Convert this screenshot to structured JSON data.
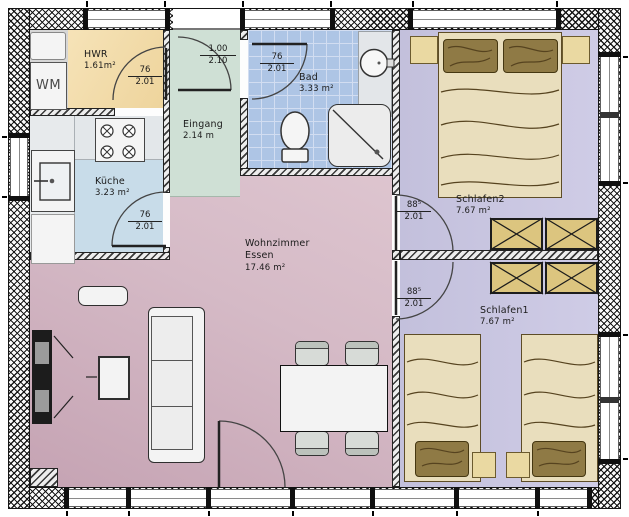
{
  "rooms": {
    "hwr": {
      "name": "HWR",
      "area": "1.61m²"
    },
    "eingang": {
      "name": "Eingang",
      "area": "2.14 m"
    },
    "bad": {
      "name": "Bad",
      "area": "3.33 m²"
    },
    "kueche": {
      "name": "Küche",
      "area": "3.23 m²"
    },
    "wohnzimmer": {
      "name1": "Wohnzimmer",
      "name2": "Essen",
      "area": "17.46 m²"
    },
    "schlafen2": {
      "name": "Schlafen2",
      "area": "7.67 m²"
    },
    "schlafen1": {
      "name": "Schlafen1",
      "area": "7.67 m²"
    }
  },
  "appliances": {
    "washing_machine": "WM"
  },
  "doors": {
    "hwr_door": {
      "width": "76",
      "height": "2.01"
    },
    "entry_door": {
      "width": "1.00",
      "height": "2.10"
    },
    "bad_door": {
      "width": "76",
      "height": "2.01"
    },
    "kueche_door": {
      "width": "76",
      "height": "2.01"
    },
    "schlafen2_door": {
      "width": "88⁵",
      "height": "2.01"
    },
    "schlafen1_door": {
      "width": "88⁵",
      "height": "2.01"
    }
  },
  "colors": {
    "hwr_fill": "#f2dca9",
    "eingang_fill": "#cfe0d5",
    "bad_tile": "#aec5e5",
    "kueche_fill": "#c8dce9",
    "wohnzimmer_fill": "#d8bfca",
    "schlafzimmer_fill": "#c8c5e0",
    "bed_linen": "#e9debd",
    "pillow": "#8f7a45",
    "wardrobe": "#dcc57f"
  }
}
